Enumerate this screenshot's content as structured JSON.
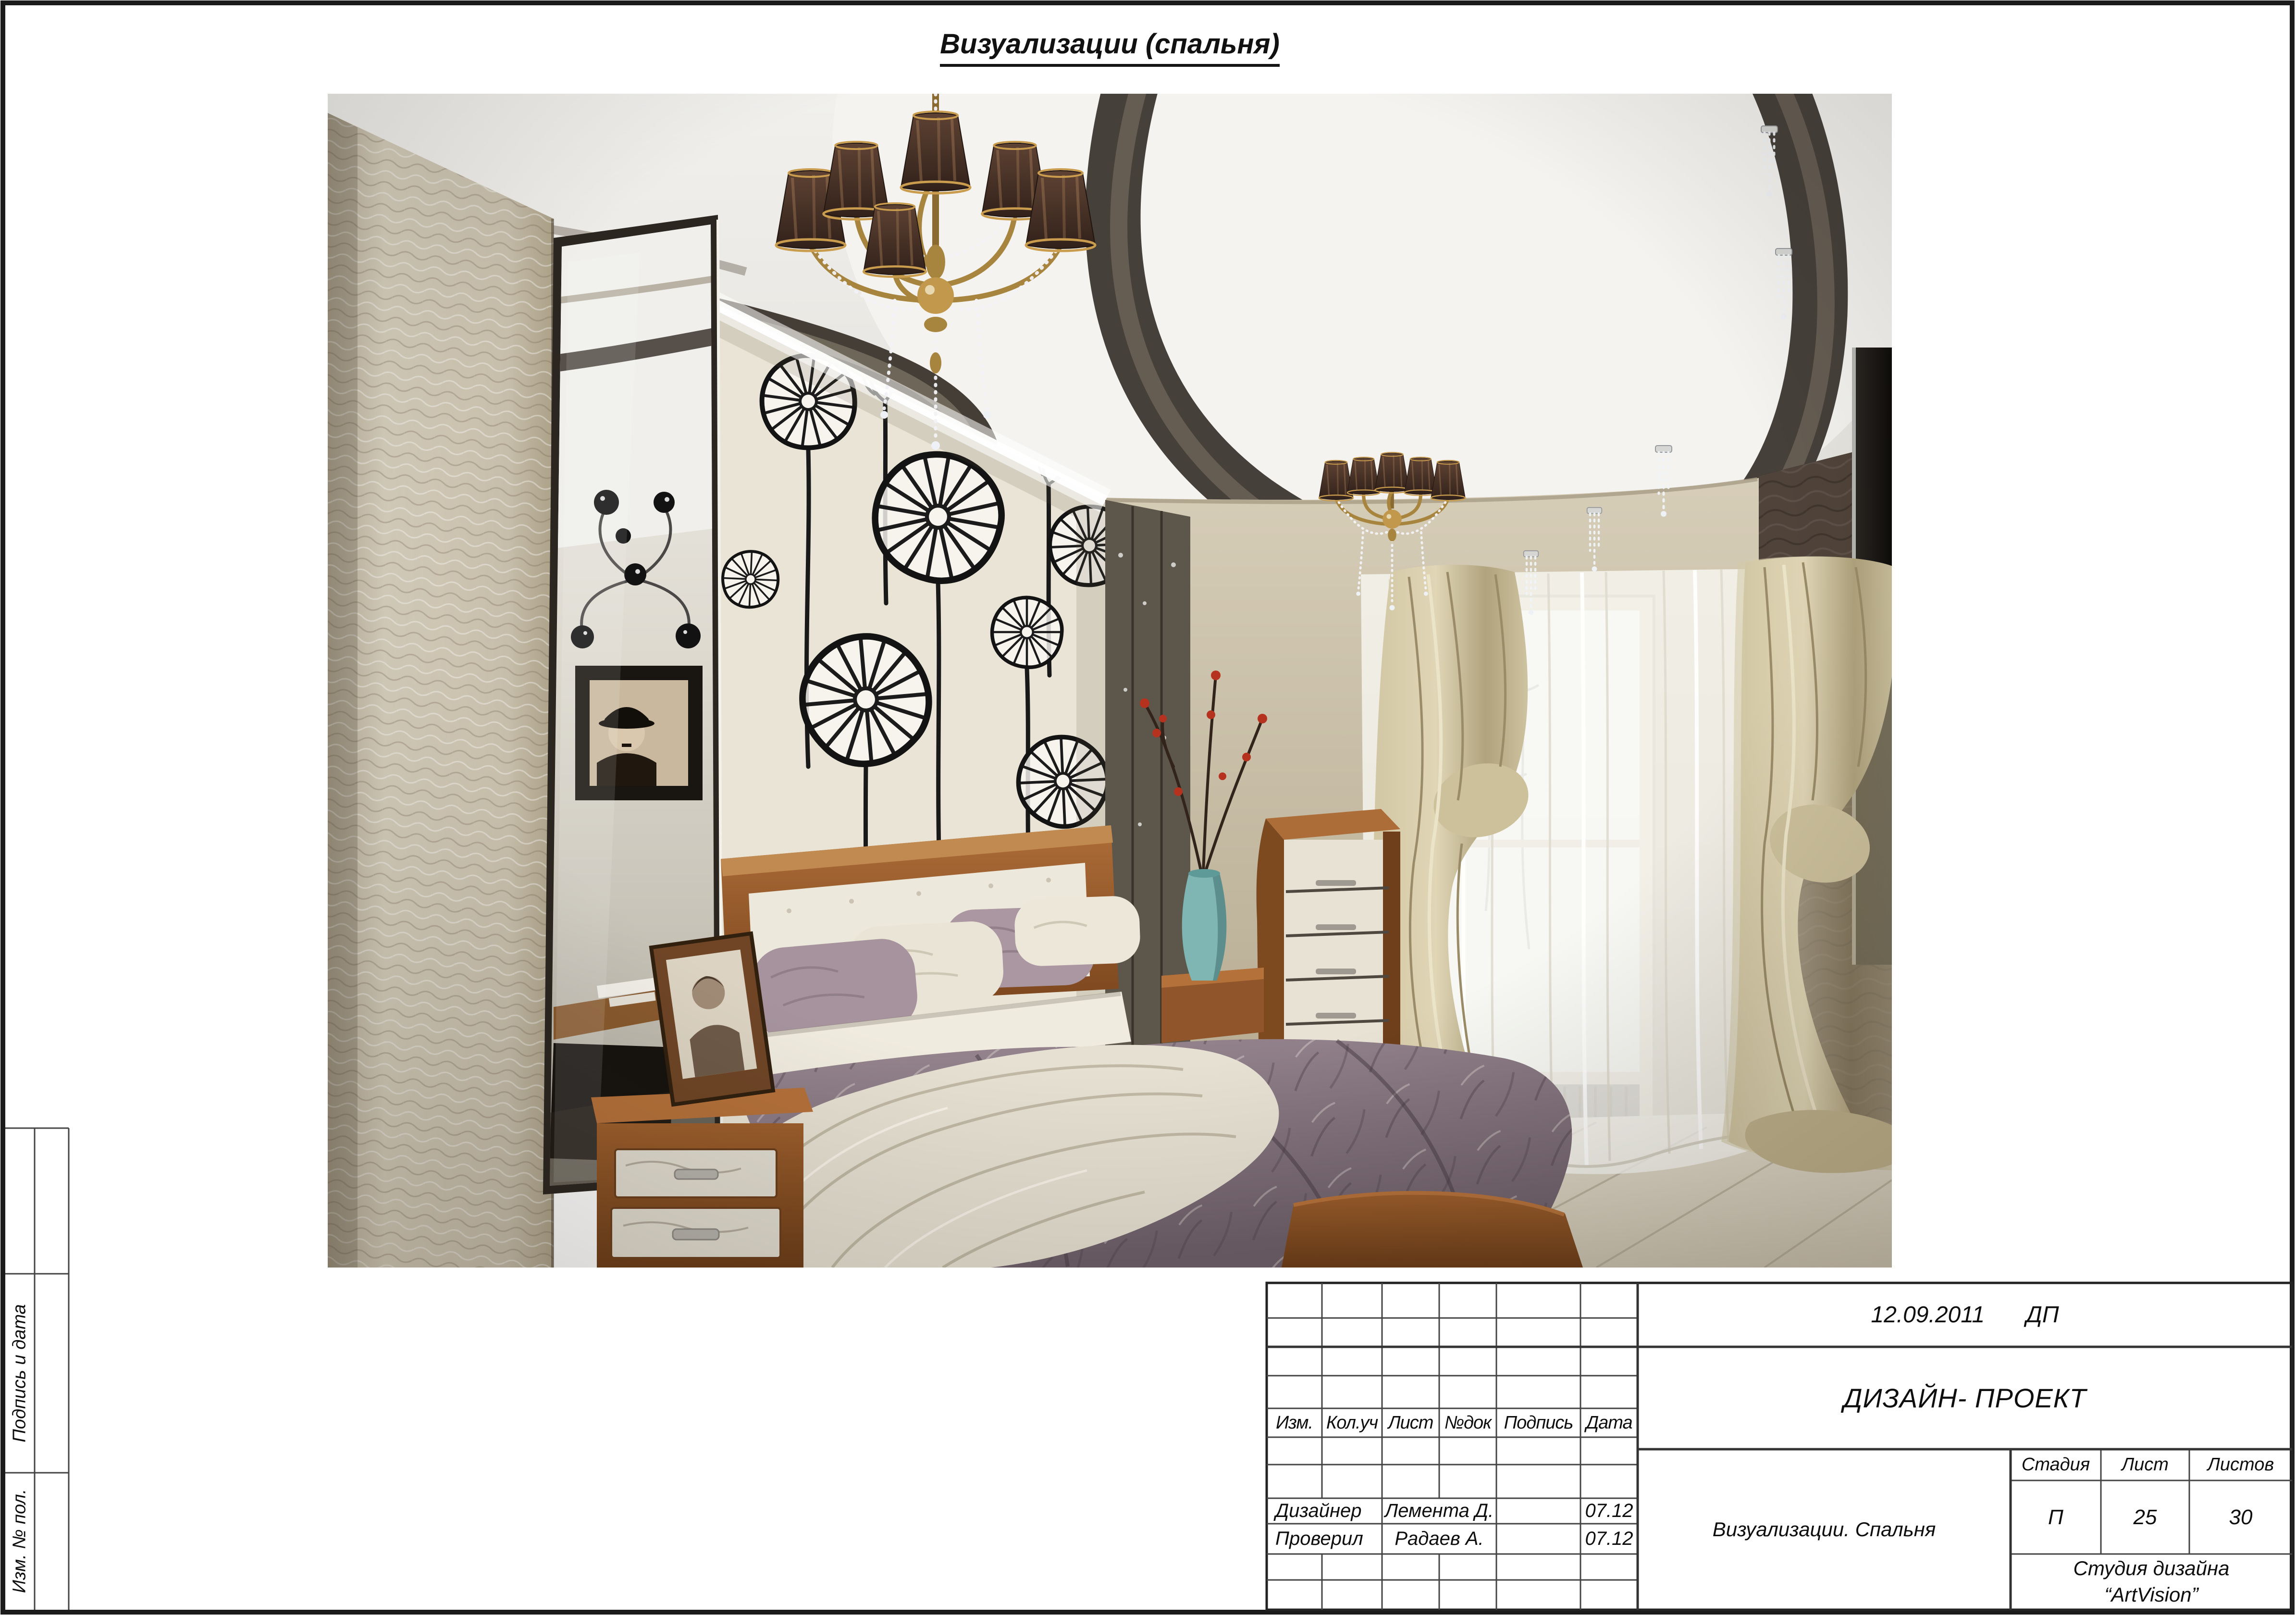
{
  "page": {
    "title": "Визуализации (спальня)"
  },
  "side_strip": {
    "top_label": "Подпись и дата",
    "bottom_label": "Изм. № пол."
  },
  "title_block": {
    "doc_date": "12.09.2011",
    "doc_code": "ДП",
    "project_title": "ДИЗАЙН- ПРОЕКТ",
    "rev_headers": [
      "Изм.",
      "Кол.уч",
      "Лист",
      "№док",
      "Подпись",
      "Дата"
    ],
    "signature_rows": [
      {
        "role": "Дизайнер",
        "name": "Лемента Д.",
        "date": "07.12"
      },
      {
        "role": "Проверил",
        "name": "Радаев А.",
        "date": "07.12"
      }
    ],
    "stage_label": "Стадия",
    "sheet_label": "Лист",
    "sheets_label": "Листов",
    "stage_value": "П",
    "sheet_value": "25",
    "sheets_value": "30",
    "sheet_title": "Визуализации. Спальня",
    "studio_line1": "Студия дизайна",
    "studio_line2": "“ArtVision”"
  },
  "colors": {
    "frame": "#1b1b1b",
    "line": "#444444",
    "paper": "#ffffff"
  }
}
